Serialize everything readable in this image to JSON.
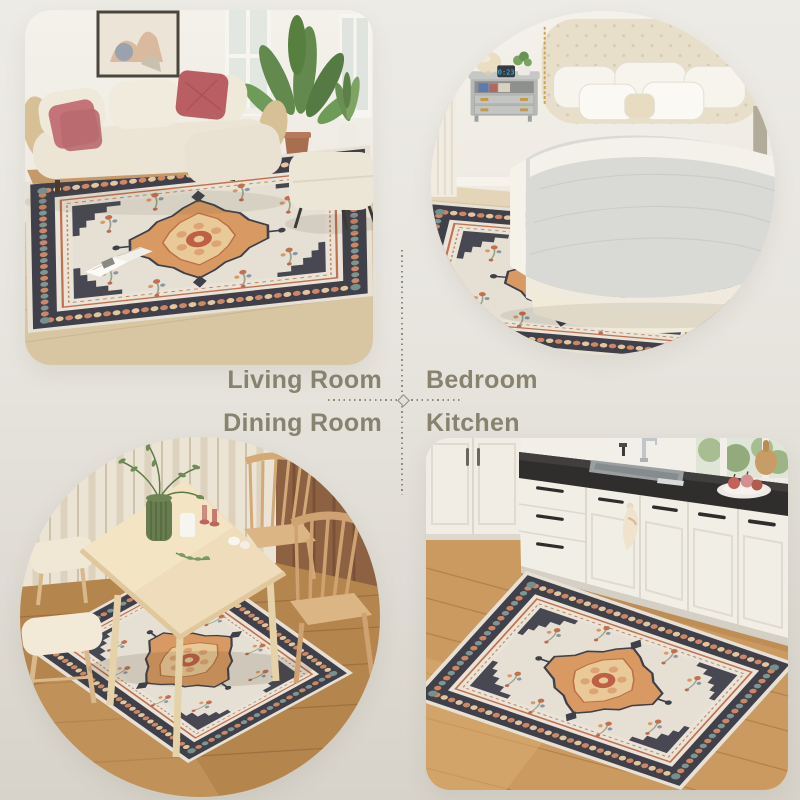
{
  "collage": {
    "labels": {
      "living_room": "Living Room",
      "bedroom": "Bedroom",
      "dining_room": "Dining Room",
      "kitchen": "Kitchen"
    },
    "colors": {
      "label_text": "#87836f",
      "divider_dots": "#8f8b7c",
      "background_top": "#edebe6",
      "background_bottom": "#d7d3ca",
      "rug_border": "#3f404a",
      "rug_field": "#e6e0d4",
      "rug_medallion": "#d89a62",
      "rug_accent": "#c2704d"
    },
    "scenes": {
      "bedroom": {
        "clock_time": "0:23"
      }
    }
  }
}
